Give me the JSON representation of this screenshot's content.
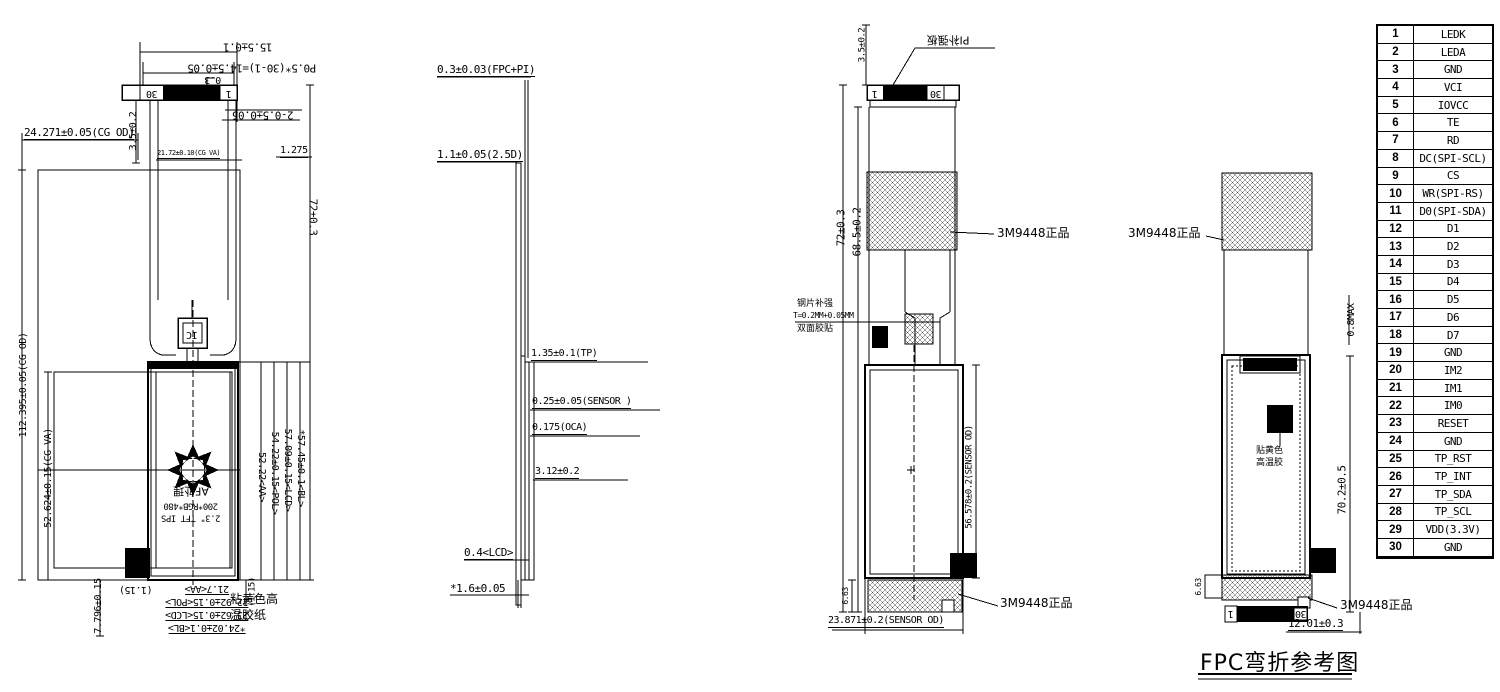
{
  "v1": {
    "d15_5": "15.5±0.1",
    "p0_5": "P0.5*(30-1)=14.5±0.05",
    "d0_3": "0.3",
    "n30": "30",
    "n1": "1",
    "d2_05": "2-0.5±0.05",
    "d3_5": "3.5±0.2",
    "d24_271": "24.271±0.05(CG OD)",
    "d21_72": "21.72±0.10(CG VA)",
    "d1_275": "1.275",
    "d72": "72±0.3",
    "d112": "112.395±0.05(CG OD)",
    "d52_624": "52.624±0.15(CG VA)",
    "ic": "IC",
    "af": "AF处理",
    "res": "200*RGB*480",
    "tft": "2.3\" TFT IPS",
    "d57_45": "*57.45±0.1<BL>",
    "d57_09": "57.09±0.15<LCD>",
    "d54_22": "54.22±0.15<POL>",
    "d52_22": "52.22<AA>",
    "d1_15l": "(1.15)",
    "d21_7": "21.7<AA>",
    "d22_92": "22.92±0.15<POL>",
    "d23_62": "23.62±0.15<LCD>",
    "d24_02": "*24.02±0.1<BL>",
    "d7_796": "7.796±0.15",
    "d1_15r": "(1.15)",
    "tape1": "粘黄色高",
    "tape2": "温胶纸"
  },
  "v2": {
    "d0_3": "0.3±0.03(FPC+PI)",
    "d1_1": "1.1±0.05(2.5D)",
    "d1_35": "1.35±0.1(TP)",
    "d0_25": "0.25±0.05(SENSOR )",
    "d0_175": "0.175(OCA)",
    "d3_12": "3.12±0.2",
    "d0_4": "0.4<LCD>",
    "d1_6": "*1.6±0.05"
  },
  "v3": {
    "d3_5": "3.5±0.2",
    "pi": "PI补强板",
    "n1": "1",
    "n30": "30",
    "d72": "72±0.3",
    "d68_5": "68.5±0.2",
    "m3m_top": "3M9448正品",
    "steel1": "钢片补强",
    "steel2": "T=0.2MM+0.05MM",
    "steel3": "双面胶贴",
    "d56_578": "56.578±0.2(SENSOR OD)",
    "d6_63": "6.63",
    "m3m_bot": "3M9448正品",
    "d23_871": "23.871±0.2(SENSOR OD)"
  },
  "v4": {
    "m3m_top": "3M9448正品",
    "d0_8": "0.8MAX",
    "glue1": "贴黄色",
    "glue2": "高温胶",
    "d70_2": "70.2±0.5",
    "d6_63": "6.63",
    "n1": "1",
    "n30": "30",
    "m3m_bot": "3M9448正品",
    "d12_01": "12.01±0.3"
  },
  "caption": "FPC弯折参考图",
  "colors": {
    "line": "#000000",
    "background": "#ffffff"
  },
  "pin_table": {
    "rows": [
      {
        "pin": "1",
        "label": "LEDK"
      },
      {
        "pin": "2",
        "label": "LEDA"
      },
      {
        "pin": "3",
        "label": "GND"
      },
      {
        "pin": "4",
        "label": "VCI"
      },
      {
        "pin": "5",
        "label": "IOVCC"
      },
      {
        "pin": "6",
        "label": "TE"
      },
      {
        "pin": "7",
        "label": "RD"
      },
      {
        "pin": "8",
        "label": "DC(SPI-SCL)"
      },
      {
        "pin": "9",
        "label": "CS"
      },
      {
        "pin": "10",
        "label": "WR(SPI-RS)"
      },
      {
        "pin": "11",
        "label": "D0(SPI-SDA)"
      },
      {
        "pin": "12",
        "label": "D1"
      },
      {
        "pin": "13",
        "label": "D2"
      },
      {
        "pin": "14",
        "label": "D3"
      },
      {
        "pin": "15",
        "label": "D4"
      },
      {
        "pin": "16",
        "label": "D5"
      },
      {
        "pin": "17",
        "label": "D6"
      },
      {
        "pin": "18",
        "label": "D7"
      },
      {
        "pin": "19",
        "label": "GND"
      },
      {
        "pin": "20",
        "label": "IM2"
      },
      {
        "pin": "21",
        "label": "IM1"
      },
      {
        "pin": "22",
        "label": "IM0"
      },
      {
        "pin": "23",
        "label": "RESET"
      },
      {
        "pin": "24",
        "label": "GND"
      },
      {
        "pin": "25",
        "label": "TP_RST"
      },
      {
        "pin": "26",
        "label": "TP_INT"
      },
      {
        "pin": "27",
        "label": "TP_SDA"
      },
      {
        "pin": "28",
        "label": "TP_SCL"
      },
      {
        "pin": "29",
        "label": "VDD(3.3V)"
      },
      {
        "pin": "30",
        "label": "GND"
      }
    ]
  }
}
